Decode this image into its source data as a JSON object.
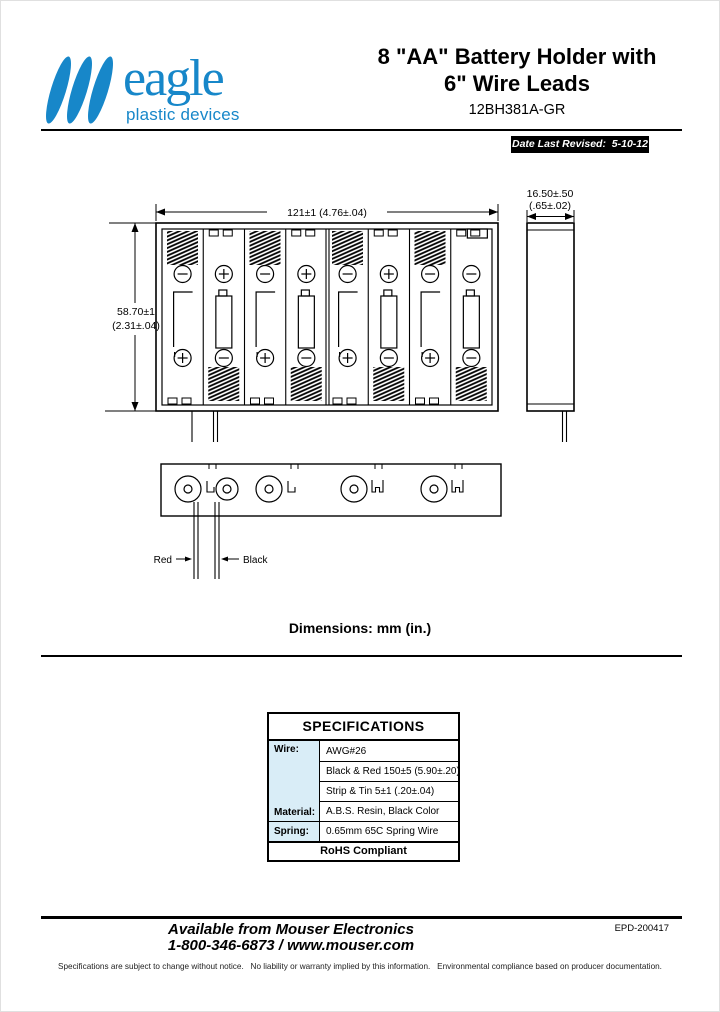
{
  "page": {
    "accent_blue": "#1787c9",
    "table_label_bg": "#d9edf7"
  },
  "header": {
    "logo": {
      "brand": "eagle",
      "tagline": "plastic devices"
    },
    "title_line1": "8 \"AA\" Battery Holder with",
    "title_line2": "6\" Wire Leads",
    "part_number": "12BH381A-GR",
    "revised_badge": "Date Last Revised:  5-10-12"
  },
  "drawing": {
    "dim_width": "121±1 (4.76±.04)",
    "dim_height_line1": "58.70±1",
    "dim_height_line2": "(2.31±.04)",
    "dim_depth_line1": "16.50±.50",
    "dim_depth_line2": "(.65±.02)",
    "wire_red_label": "Red",
    "wire_black_label": "Black",
    "units_note": "Dimensions: mm (in.)",
    "front_view_cells": [
      {
        "top": "-",
        "bottom": "+",
        "spring": "top",
        "battery": "outline"
      },
      {
        "top": "+",
        "bottom": "-",
        "spring": "bottom",
        "battery": "full"
      },
      {
        "top": "-",
        "bottom": "+",
        "spring": "top",
        "battery": "outline"
      },
      {
        "top": "+",
        "bottom": "-",
        "spring": "bottom",
        "battery": "full"
      },
      {
        "top": "-",
        "bottom": "+",
        "spring": "top",
        "battery": "outline"
      },
      {
        "top": "+",
        "bottom": "-",
        "spring": "bottom",
        "battery": "full"
      },
      {
        "top": "-",
        "bottom": "+",
        "spring": "top",
        "battery": "outline"
      },
      {
        "top": "-",
        "bottom": "-",
        "spring": "bottom",
        "battery": "full",
        "top_tab": true
      }
    ]
  },
  "specifications": {
    "title": "SPECIFICATIONS",
    "wire_label": "Wire:",
    "material_label": "Material:",
    "spring_label": "Spring:",
    "wire_values": [
      "AWG#26",
      "Black & Red 150±5 (5.90±.20)",
      "Strip & Tin 5±1 (.20±.04)"
    ],
    "material_value": "A.B.S. Resin, Black Color",
    "spring_value": "0.65mm 65C Spring Wire",
    "footer": "RoHS Compliant"
  },
  "footer": {
    "available_line1": "Available from Mouser Electronics",
    "available_line2": "1-800-346-6873 / www.mouser.com",
    "doc_number": "EPD-200417",
    "disclaimer": "Specifications are subject to change without notice.   No liability or warranty implied by this information.   Environmental compliance based on producer documentation."
  }
}
